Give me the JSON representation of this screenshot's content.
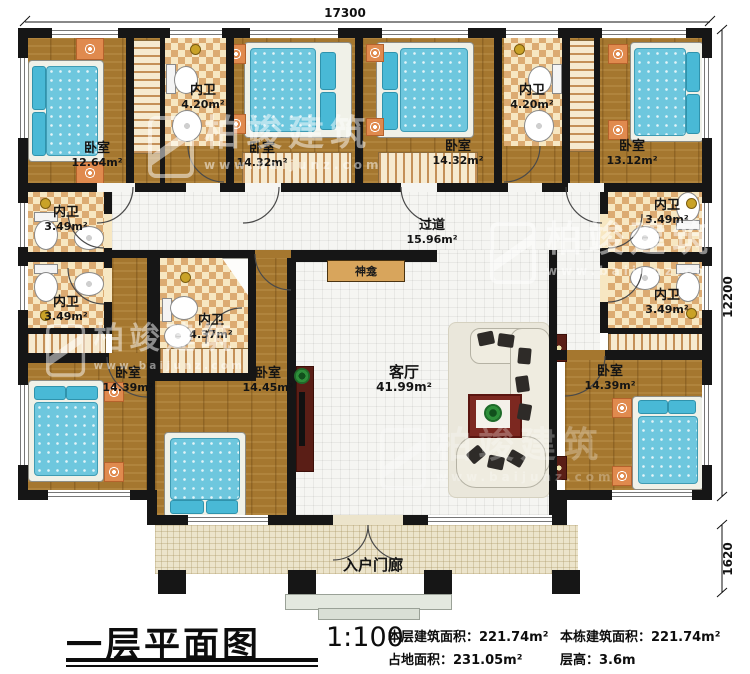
{
  "plan": {
    "rooms": [
      {
        "name": "卧室",
        "area": "12.64m²"
      },
      {
        "name": "内卫",
        "area": "4.20m²"
      },
      {
        "name": "卧室",
        "area": "14.32m²"
      },
      {
        "name": "卧室",
        "area": "14.32m²"
      },
      {
        "name": "内卫",
        "area": "4.20m²"
      },
      {
        "name": "卧室",
        "area": "13.12m²"
      },
      {
        "name": "内卫",
        "area": "3.49m²"
      },
      {
        "name": "内卫",
        "area": "3.49m²"
      },
      {
        "name": "过道",
        "area": "15.96m²"
      },
      {
        "name": "内卫",
        "area": "3.49m²"
      },
      {
        "name": "内卫",
        "area": "3.49m²"
      },
      {
        "name": "卧室",
        "area": "14.39m²"
      },
      {
        "name": "内卫",
        "area": "4.37m²"
      },
      {
        "name": "卧室",
        "area": "14.45m²"
      },
      {
        "name": "客厅",
        "area": "41.99m²"
      },
      {
        "name": "卧室",
        "area": "14.39m²"
      }
    ],
    "shrine": "神龛",
    "porch": "入户门廊",
    "dims": {
      "top": "17300",
      "right_main": "12200",
      "right_porch": "1620"
    }
  },
  "title_block": {
    "title": "一层平面图",
    "scale": "1:100",
    "stats": [
      {
        "label": "本层建筑面积：",
        "value": "221.74m²"
      },
      {
        "label": "本栋建筑面积：",
        "value": "221.74m²"
      },
      {
        "label": "占地面积：",
        "value": "231.05m²"
      },
      {
        "label": "层高：",
        "value": "3.6m"
      }
    ]
  },
  "watermark": {
    "brand": "柏竣建筑",
    "url": "www.baijunz.com"
  }
}
